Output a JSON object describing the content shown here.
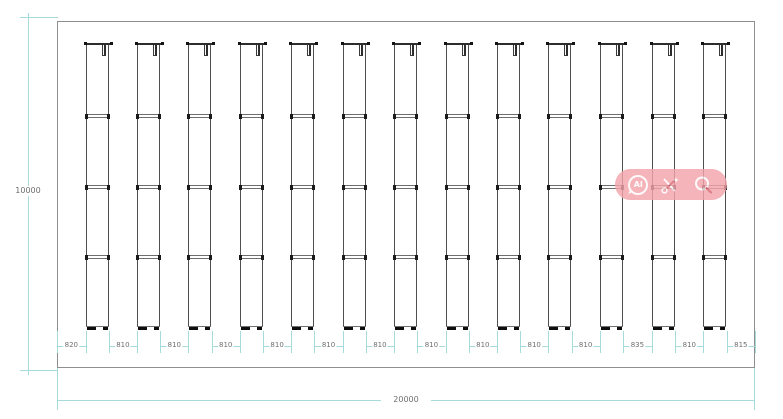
{
  "dimensions": {
    "overall_width": "20000",
    "overall_height": "10000",
    "segments": [
      "820",
      "810",
      "810",
      "810",
      "810",
      "810",
      "810",
      "810",
      "810",
      "810",
      "810",
      "835",
      "810",
      "815"
    ]
  },
  "racks": {
    "count": 13,
    "shelf_rows_per_rack": 3
  },
  "watermark": {
    "ai_label": "AI",
    "icons": [
      "ai-chat-icon",
      "scissors-icon",
      "magnifier-icon"
    ]
  },
  "colors": {
    "dimension_line": "#a6dbdb",
    "dimension_text": "#6f6f6f",
    "border": "#8f8f8f",
    "structure": "#4f4f4f",
    "watermark_bg": "#f2a4ab",
    "watermark_icon": "#ffffff",
    "watermark_accent": "#d4636e"
  }
}
